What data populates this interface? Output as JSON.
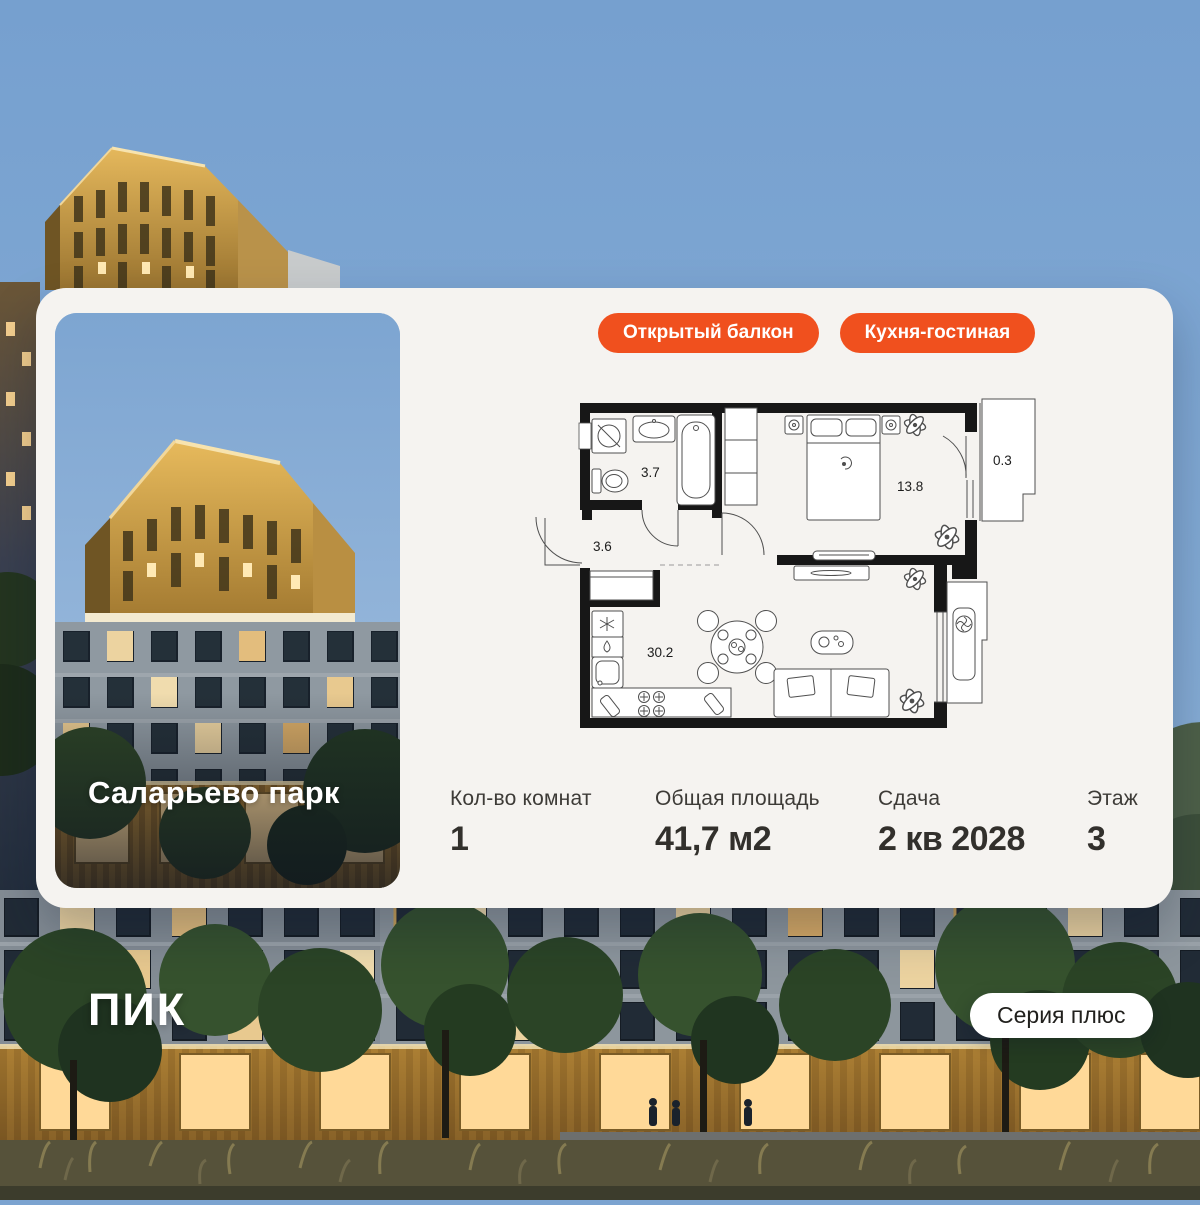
{
  "colors": {
    "accent_orange": "#F0501E",
    "card_background": "#F5F3F0",
    "sky_blue": "#7BA3D0",
    "text_dark": "#32302C",
    "plan_wall": "#171717"
  },
  "project": {
    "name": "Саларьево парк"
  },
  "badges": [
    {
      "label": "Открытый балкон"
    },
    {
      "label": "Кухня-гостиная"
    }
  ],
  "floorplan": {
    "areas": {
      "bathroom": "3.7",
      "hallway": "3.6",
      "bedroom": "13.8",
      "balcony": "0.3",
      "kitchen_living": "30.2"
    }
  },
  "stats": [
    {
      "label": "Кол-во комнат",
      "value": "1"
    },
    {
      "label": "Общая площадь",
      "value": "41,7 м2"
    },
    {
      "label": "Сдача",
      "value": "2 кв 2028"
    },
    {
      "label": "Этаж",
      "value": "3"
    }
  ],
  "brand": {
    "logo": "ПИК"
  },
  "series_badge": {
    "label": "Серия плюс"
  }
}
